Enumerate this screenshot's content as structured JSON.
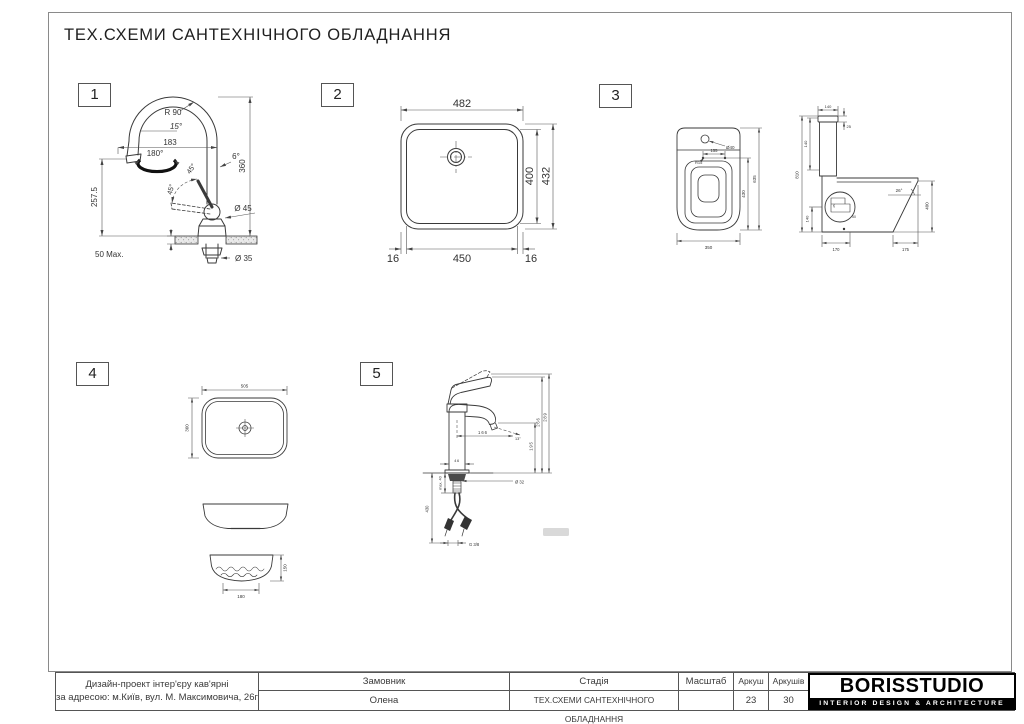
{
  "sheet": {
    "title": "ТЕХ.СХЕМИ САНТЕХНІЧНОГО ОБЛАДНАННЯ"
  },
  "drawings": {
    "d1": {
      "number": "1",
      "dims": {
        "r90": "R 90",
        "a15": "15°",
        "reach": "183",
        "a180": "180°",
        "a45a": "45°",
        "a45b": "45°",
        "a6": "6°",
        "h360": "360",
        "h2575": "257.5",
        "d45": "Ø 45",
        "max50": "50 Max.",
        "d35": "Ø 35"
      }
    },
    "d2": {
      "number": "2",
      "dims": {
        "w482": "482",
        "h400": "400",
        "h432": "432",
        "b16l": "16",
        "b450": "450",
        "b16r": "16"
      }
    },
    "d3": {
      "number": "3",
      "dims": {
        "d40": "Ø40",
        "w155": "155",
        "r15": "R15",
        "h430": "430",
        "h635": "635",
        "w350": "350",
        "w140": "140",
        "t25": "25",
        "h140": "140",
        "h810": "810",
        "h140b": "140",
        "a26": "26°",
        "h400": "400",
        "tiny25": "25",
        "tiny50": "50",
        "b170": "170",
        "b175": "175"
      }
    },
    "d4": {
      "number": "4",
      "dims": {
        "w505": "505",
        "h360": "360",
        "h150": "150",
        "w180": "180"
      }
    },
    "d5": {
      "number": "5",
      "dims": {
        "reach166": "166",
        "a13": "13°",
        "h195": "195",
        "h266": "266",
        "h289": "289",
        "w46": "46",
        "d32": "Ø 32",
        "max40": "max. 40",
        "h430": "430",
        "g38": "G 3/8"
      }
    }
  },
  "title_block": {
    "project_line1": "Дизайн-проект інтер'єру кав'ярні",
    "project_line2": "за адресою: м.Київ, вул. М. Максимовича, 26г",
    "customer_label": "Замовник",
    "customer_value": "Олена",
    "stage_label": "Стадія",
    "stage_value": "ТЕХ.СХЕМИ САНТЕХНІЧНОГО ОБЛАДНАННЯ",
    "scale_label": "Масштаб",
    "scale_value": "",
    "sheet_label": "Аркуш",
    "sheet_value": "23",
    "sheets_label": "Аркушів",
    "sheets_value": "30",
    "logo_name": "BORISSTUDIO",
    "logo_tagline": "INTERIOR DESIGN & ARCHITECTURE"
  }
}
